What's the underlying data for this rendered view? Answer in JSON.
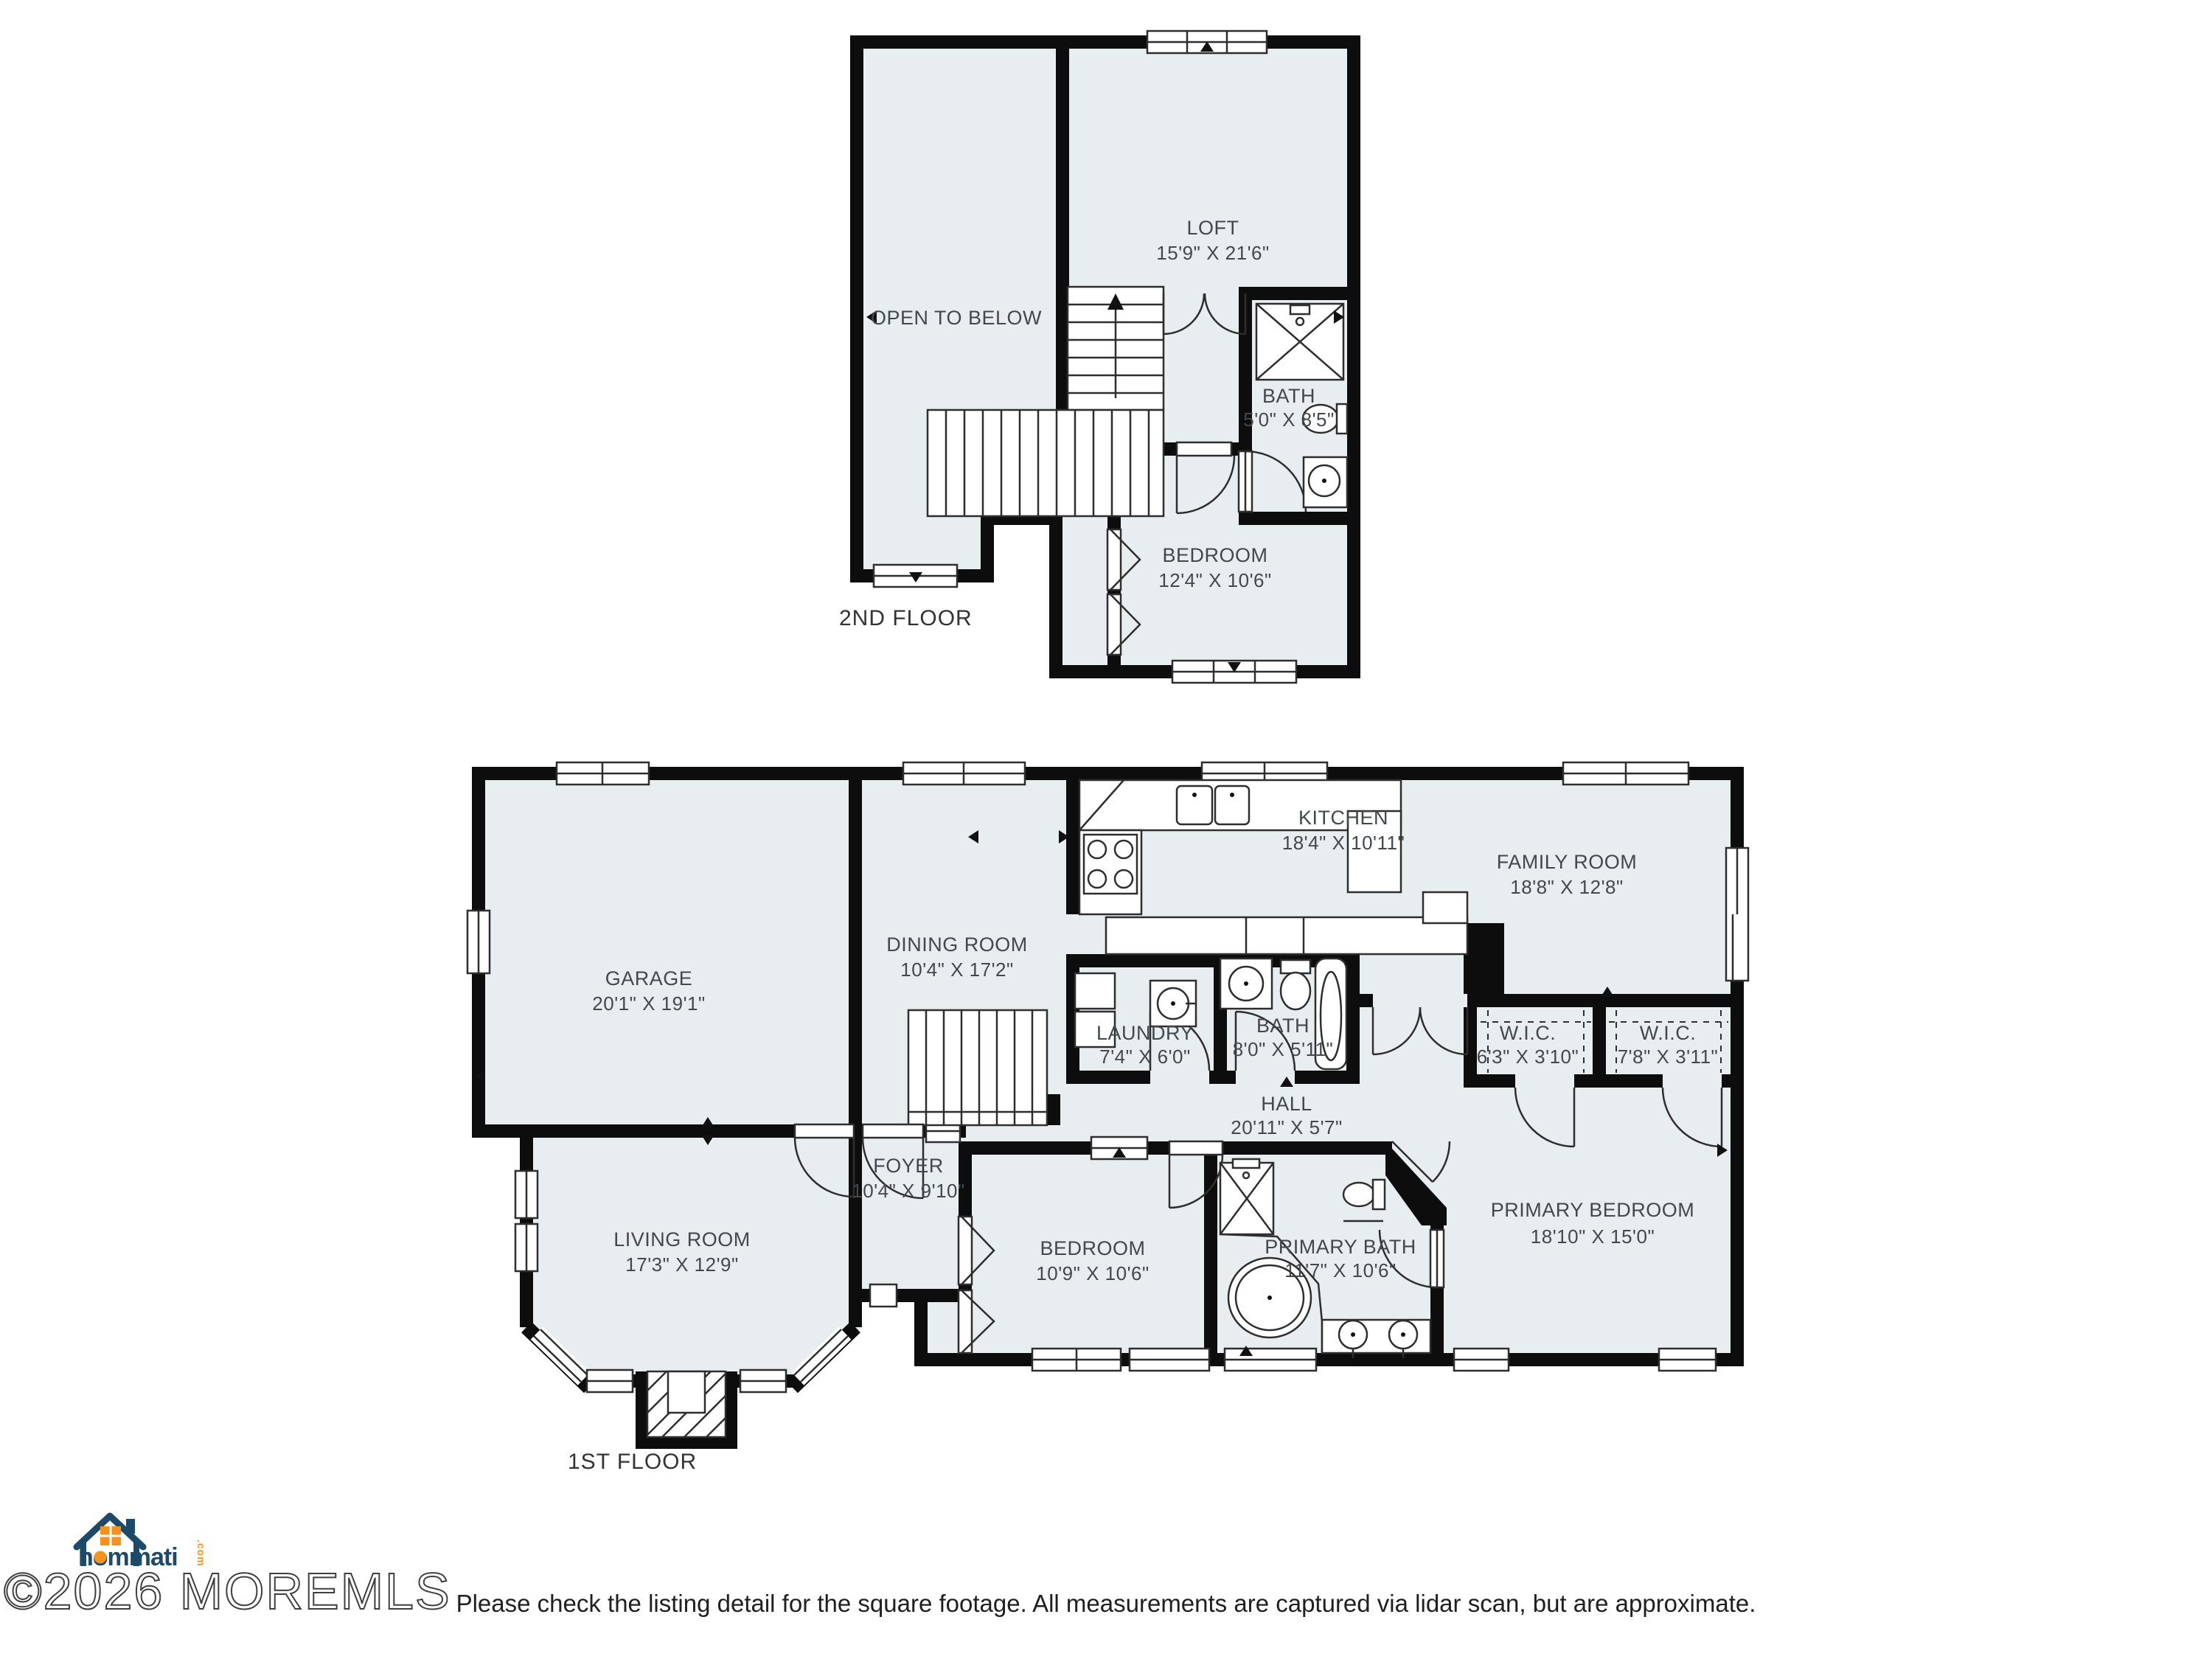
{
  "colors": {
    "floor_fill": "#e8edf0",
    "wall": "#0d0d0d",
    "brand_navy": "#1c4a68",
    "brand_orange": "#f5921e"
  },
  "floor2": {
    "label": "2ND FLOOR",
    "rooms": {
      "open": {
        "name": "OPEN TO BELOW"
      },
      "loft": {
        "name": "LOFT",
        "dims": "15'9\" X 21'6\""
      },
      "bath": {
        "name": "BATH",
        "dims": "5'0\" X 8'5\""
      },
      "bedroom": {
        "name": "BEDROOM",
        "dims": "12'4\" X 10'6\""
      }
    }
  },
  "floor1": {
    "label": "1ST FLOOR",
    "rooms": {
      "garage": {
        "name": "GARAGE",
        "dims": "20'1\" X 19'1\""
      },
      "dining": {
        "name": "DINING ROOM",
        "dims": "10'4\" X 17'2\""
      },
      "kitchen": {
        "name": "KITCHEN",
        "dims": "18'4\" X 10'11\""
      },
      "family": {
        "name": "FAMILY ROOM",
        "dims": "18'8\" X 12'8\""
      },
      "laundry": {
        "name": "LAUNDRY",
        "dims": "7'4\" X 6'0\""
      },
      "bath": {
        "name": "BATH",
        "dims": "8'0\" X 5'11\""
      },
      "wic_left": {
        "name": "W.I.C.",
        "dims": "6'3\" X 3'10\""
      },
      "wic_right": {
        "name": "W.I.C.",
        "dims": "7'8\" X 3'11\""
      },
      "hall": {
        "name": "HALL",
        "dims": "20'11\" X 5'7\""
      },
      "foyer": {
        "name": "FOYER",
        "dims": "10'4\" X 9'10\""
      },
      "living": {
        "name": "LIVING ROOM",
        "dims": "17'3\" X 12'9\""
      },
      "bedroom": {
        "name": "BEDROOM",
        "dims": "10'9\" X 10'6\""
      },
      "primary_bath": {
        "name": "PRIMARY BATH",
        "dims": "11'7\" X 10'6\""
      },
      "primary_bedroom": {
        "name": "PRIMARY BEDROOM",
        "dims": "18'10\" X 15'0\""
      }
    }
  },
  "watermark": "©2026 MOREMLS",
  "logo": {
    "brand": "hommati",
    "tld": ".com"
  },
  "disclaimer": "Please check the listing detail for the square footage. All measurements are captured via lidar scan, but are approximate."
}
